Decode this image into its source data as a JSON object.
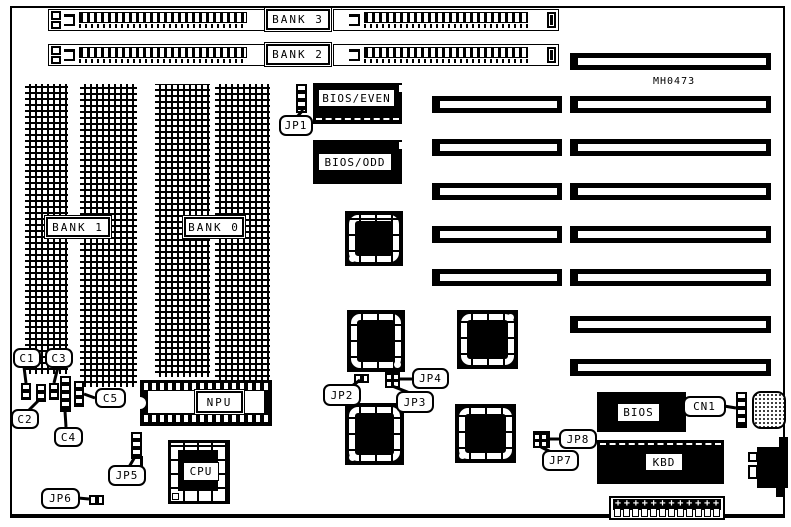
{
  "part_number": "MH0473",
  "colors": {
    "ink": "#000000",
    "background": "#ffffff"
  },
  "memory": {
    "simm_rows": [
      {
        "label": "BANK 3"
      },
      {
        "label": "BANK 2"
      }
    ],
    "dram_banks": [
      {
        "label": "BANK 1"
      },
      {
        "label": "BANK 0"
      }
    ]
  },
  "chips": {
    "bios_even": "BIOS/EVEN",
    "bios_odd": "BIOS/ODD",
    "npu": "NPU",
    "cpu": "CPU",
    "bios": "BIOS",
    "kbd": "KBD"
  },
  "jumpers": {
    "jp1": "JP1",
    "jp2": "JP2",
    "jp3": "JP3",
    "jp4": "JP4",
    "jp5": "JP5",
    "jp6": "JP6",
    "jp7": "JP7",
    "jp8": "JP8"
  },
  "capacitors": {
    "c1": "C1",
    "c2": "C2",
    "c3": "C3",
    "c4": "C4",
    "c5": "C5"
  },
  "connectors": {
    "cn1": "CN1"
  },
  "expansion_slots": {
    "long_count": 8,
    "short_count": 5
  },
  "power_connector": {
    "pin_count": 12
  }
}
